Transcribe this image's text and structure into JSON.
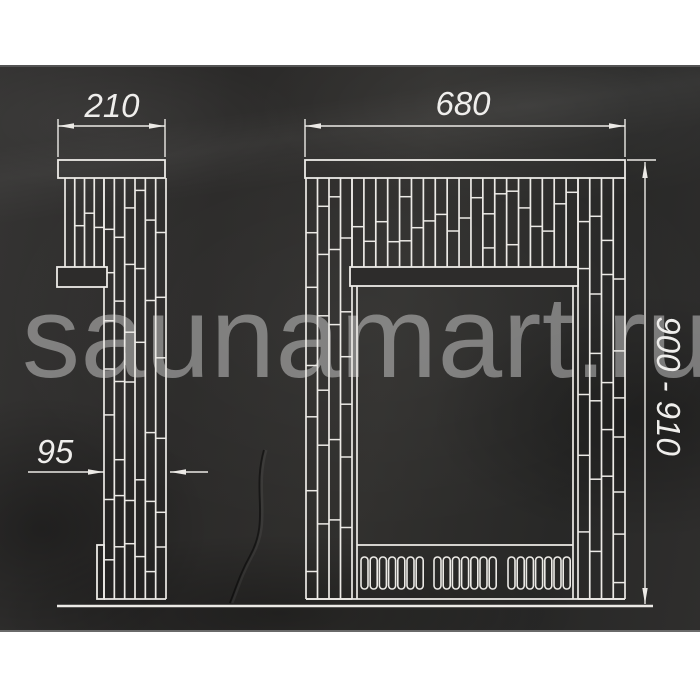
{
  "watermark": {
    "text": "saunamart.ru"
  },
  "dims": {
    "side_width": {
      "label": "210"
    },
    "front_width": {
      "label": "680"
    },
    "side_lower_depth": {
      "label": "95"
    },
    "height_range": {
      "label": "900 - 910"
    }
  },
  "colors": {
    "page_bg": "#ffffff",
    "panel_bg": "#2d2c2b",
    "line": "#eceae6",
    "dim_text": "#efeeec",
    "watermark": "rgba(219,219,219,0.47)"
  },
  "drawing": {
    "stroke_w": 1.7,
    "regions": [
      {
        "name": "side-band",
        "x1": 65,
        "x2": 104,
        "y1": 178,
        "y2": 267,
        "strips": 4
      },
      {
        "name": "side-column",
        "x1": 104,
        "x2": 166,
        "y1": 178,
        "y2": 599,
        "strips": 6,
        "bottom": true
      },
      {
        "name": "front-band",
        "x1": 352,
        "x2": 578,
        "y1": 178,
        "y2": 267,
        "strips": 19
      },
      {
        "name": "front-left-column",
        "x1": 306,
        "x2": 352,
        "y1": 178,
        "y2": 599,
        "strips": 4,
        "bottom": true
      },
      {
        "name": "front-right-column",
        "x1": 578,
        "x2": 625,
        "y1": 178,
        "y2": 599,
        "strips": 4,
        "bottom": true
      }
    ],
    "rects": [
      {
        "name": "side-shelf",
        "x": 58,
        "y": 160,
        "w": 107,
        "h": 18
      },
      {
        "name": "front-shelf",
        "x": 305,
        "y": 160,
        "w": 320,
        "h": 18
      },
      {
        "name": "side-ledge",
        "x": 57,
        "y": 267,
        "w": 50,
        "h": 20,
        "fill": true
      },
      {
        "name": "front-lintel",
        "x": 350,
        "y": 267,
        "w": 228,
        "h": 19,
        "fill": true
      },
      {
        "name": "side-base-step",
        "x": 97,
        "y": 545,
        "w": 7,
        "h": 54
      }
    ],
    "lines": [
      {
        "name": "left-jamb",
        "x1": 357,
        "y1": 286,
        "x2": 357,
        "y2": 599
      },
      {
        "name": "right-jamb",
        "x1": 573,
        "y1": 286,
        "x2": 573,
        "y2": 599
      },
      {
        "name": "sill",
        "x1": 357,
        "y1": 545,
        "x2": 573,
        "y2": 545
      },
      {
        "name": "front-bottom",
        "x1": 306,
        "y1": 599,
        "x2": 625,
        "y2": 599
      },
      {
        "name": "floor",
        "x1": 57,
        "y1": 606,
        "x2": 653,
        "y2": 606,
        "w": 2.6
      }
    ],
    "vents": {
      "y": 557,
      "h": 32,
      "w": 7,
      "pitch": 9.2,
      "count": 7,
      "groups": [
        361,
        434,
        508
      ]
    },
    "dims": [
      {
        "name": "dim-210",
        "type": "h",
        "y": 126,
        "x1": 58,
        "x2": 165,
        "ext_y1": 119,
        "ext_y2": 157
      },
      {
        "name": "dim-680",
        "type": "h",
        "y": 126,
        "x1": 305,
        "x2": 625,
        "ext_y1": 119,
        "ext_y2": 157
      },
      {
        "name": "dim-95",
        "type": "h-out",
        "y": 472,
        "x1": 104,
        "x2": 170,
        "tail1": 28,
        "tail2": 208
      },
      {
        "name": "dim-900",
        "type": "v",
        "x": 645,
        "y1": 162,
        "y2": 604,
        "ext": {
          "x1": 627,
          "x2": 656,
          "y": 160
        }
      }
    ],
    "crack": "M264,450 C252,492 270,520 250,556 C240,574 236,588 230,603"
  }
}
